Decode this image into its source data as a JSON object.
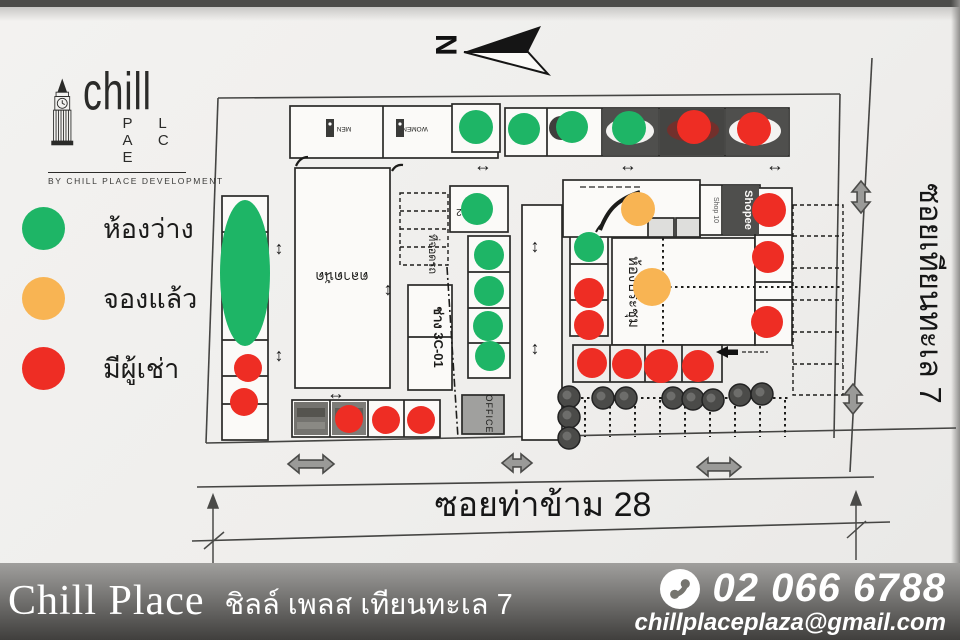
{
  "branding": {
    "logo_word": "chill",
    "logo_word2": "P L A C E",
    "tagline": "BY CHILL PLACE DEVELOPMENT"
  },
  "legend": {
    "items": [
      {
        "label": "ห้องว่าง",
        "status": "vacant"
      },
      {
        "label": "จองแล้ว",
        "status": "reserved"
      },
      {
        "label": "มีผู้เช่า",
        "status": "occupied"
      }
    ]
  },
  "compass": {
    "letter": "N"
  },
  "map": {
    "status_colors": {
      "vacant": "#1eb566",
      "reserved": "#f8b453",
      "occupied": "#ee2d24"
    },
    "streets": {
      "bottom": "ซอยท่าข้าม 28",
      "right": "ซอยเทียนทะเล 7"
    },
    "labels": {
      "market": "ตลาดนัด",
      "parking": "ที่จอดรถ",
      "workshop": "ช่าง 3C-01",
      "meeting_room": "ห้องประชุม",
      "office": "OFFICE",
      "shop10": "Shop 10",
      "shopee": "Shopee",
      "men": "MEN",
      "women": "WOMEN",
      "unit2": "2",
      "unit03": "03",
      "unit02": "02"
    },
    "icons": {
      "h_arrow": "↔",
      "v_arrow": "↕"
    },
    "dots": [
      {
        "x": 476,
        "y": 127,
        "r": 17,
        "s": "vacant"
      },
      {
        "x": 524,
        "y": 129,
        "r": 16,
        "s": "vacant"
      },
      {
        "x": 572,
        "y": 127,
        "r": 16,
        "s": "vacant"
      },
      {
        "x": 629,
        "y": 128,
        "r": 17,
        "s": "vacant"
      },
      {
        "x": 694,
        "y": 127,
        "r": 17,
        "s": "occupied"
      },
      {
        "x": 754,
        "y": 129,
        "r": 17,
        "s": "occupied"
      },
      {
        "x": 477,
        "y": 209,
        "r": 16,
        "s": "vacant"
      },
      {
        "x": 489,
        "y": 255,
        "r": 15,
        "s": "vacant"
      },
      {
        "x": 489,
        "y": 291,
        "r": 15,
        "s": "vacant"
      },
      {
        "x": 488,
        "y": 326,
        "r": 15,
        "s": "vacant"
      },
      {
        "x": 490,
        "y": 356,
        "r": 15,
        "s": "vacant"
      },
      {
        "x": 589,
        "y": 247,
        "r": 15,
        "s": "vacant"
      },
      {
        "x": 589,
        "y": 293,
        "r": 15,
        "s": "occupied"
      },
      {
        "x": 589,
        "y": 325,
        "r": 15,
        "s": "occupied"
      },
      {
        "x": 638,
        "y": 209,
        "r": 17,
        "s": "reserved"
      },
      {
        "x": 652,
        "y": 287,
        "r": 19,
        "s": "reserved"
      },
      {
        "x": 769,
        "y": 210,
        "r": 17,
        "s": "occupied"
      },
      {
        "x": 768,
        "y": 257,
        "r": 16,
        "s": "occupied"
      },
      {
        "x": 767,
        "y": 322,
        "r": 16,
        "s": "occupied"
      },
      {
        "x": 248,
        "y": 368,
        "r": 14,
        "s": "occupied"
      },
      {
        "x": 244,
        "y": 402,
        "r": 14,
        "s": "occupied"
      },
      {
        "x": 592,
        "y": 363,
        "r": 15,
        "s": "occupied"
      },
      {
        "x": 627,
        "y": 364,
        "r": 15,
        "s": "occupied"
      },
      {
        "x": 661,
        "y": 366,
        "r": 17,
        "s": "occupied"
      },
      {
        "x": 698,
        "y": 366,
        "r": 16,
        "s": "occupied"
      },
      {
        "x": 349,
        "y": 419,
        "r": 14,
        "s": "occupied"
      },
      {
        "x": 386,
        "y": 420,
        "r": 14,
        "s": "occupied"
      },
      {
        "x": 421,
        "y": 420,
        "r": 14,
        "s": "occupied"
      }
    ],
    "vacant_zone": {
      "x": 245,
      "y": 273,
      "rx": 25,
      "ry": 73
    },
    "trees": [
      [
        569,
        397
      ],
      [
        569,
        417
      ],
      [
        569,
        438
      ],
      [
        603,
        398
      ],
      [
        626,
        398
      ],
      [
        673,
        398
      ],
      [
        693,
        399
      ],
      [
        713,
        400
      ],
      [
        740,
        395
      ],
      [
        762,
        394
      ]
    ],
    "flow_arrows": [
      {
        "x": 483,
        "y": 171,
        "dir": "h"
      },
      {
        "x": 628,
        "y": 171,
        "dir": "h"
      },
      {
        "x": 775,
        "y": 171,
        "dir": "h"
      },
      {
        "x": 336,
        "y": 399,
        "dir": "h"
      },
      {
        "x": 279,
        "y": 254,
        "dir": "v"
      },
      {
        "x": 279,
        "y": 361,
        "dir": "v"
      },
      {
        "x": 388,
        "y": 295,
        "dir": "v"
      },
      {
        "x": 535,
        "y": 252,
        "dir": "v"
      },
      {
        "x": 535,
        "y": 354,
        "dir": "v"
      }
    ],
    "road_arrows": [
      {
        "x": 311,
        "y": 464,
        "len": 46,
        "dir": "h"
      },
      {
        "x": 517,
        "y": 463,
        "len": 30,
        "dir": "h"
      },
      {
        "x": 719,
        "y": 467,
        "len": 44,
        "dir": "h"
      },
      {
        "x": 861,
        "y": 197,
        "len": 32,
        "dir": "v"
      },
      {
        "x": 853,
        "y": 399,
        "len": 30,
        "dir": "v"
      }
    ]
  },
  "footer": {
    "brand": "Chill Place",
    "subtitle": "ชิลล์ เพลส เทียนทะเล 7",
    "phone": "02 066 6788",
    "email": "chillplaceplaza@gmail.com"
  }
}
